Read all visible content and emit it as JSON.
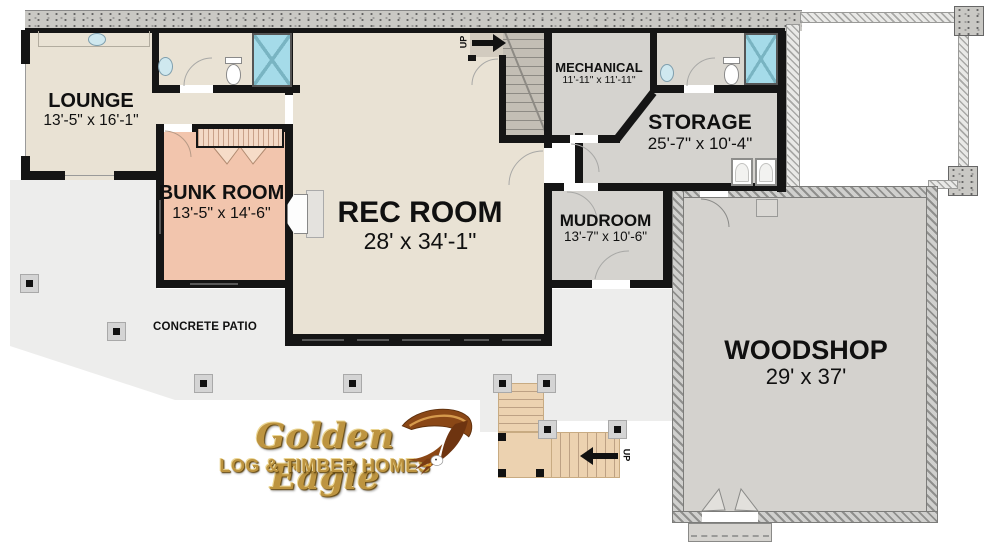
{
  "rooms": {
    "lounge": {
      "name": "LOUNGE",
      "dims": "13'-5\" x 16'-1\""
    },
    "bunk": {
      "name": "BUNK ROOM",
      "dims": "13'-5\" x 14'-6\""
    },
    "rec": {
      "name": "REC ROOM",
      "dims": "28' x 34'-1\""
    },
    "mechanical": {
      "name": "MECHANICAL",
      "dims": "11'-11\" x 11'-11\""
    },
    "storage": {
      "name": "STORAGE",
      "dims": "25'-7\" x 10'-4\""
    },
    "mudroom": {
      "name": "MUDROOM",
      "dims": "13'-7\" x 10'-6\""
    },
    "woodshop": {
      "name": "WOODSHOP",
      "dims": "29' x 37'"
    }
  },
  "labels": {
    "patio": "CONCRETE PATIO",
    "up_top": "UP",
    "up_bottom": "UP"
  },
  "logo": {
    "name": "Golden Eagle",
    "tagline": "LOG & TIMBER HOMES"
  },
  "colors": {
    "room_beige": "#e9e2d4",
    "room_salmon": "#f2c5ad",
    "room_gray": "#d5d3cf",
    "patio_gray": "#ededec",
    "deck_wood": "#ecd2b0",
    "shower_blue": "#a5dbe9",
    "wall_black": "#151515",
    "logo_gold": "#bd9440"
  }
}
